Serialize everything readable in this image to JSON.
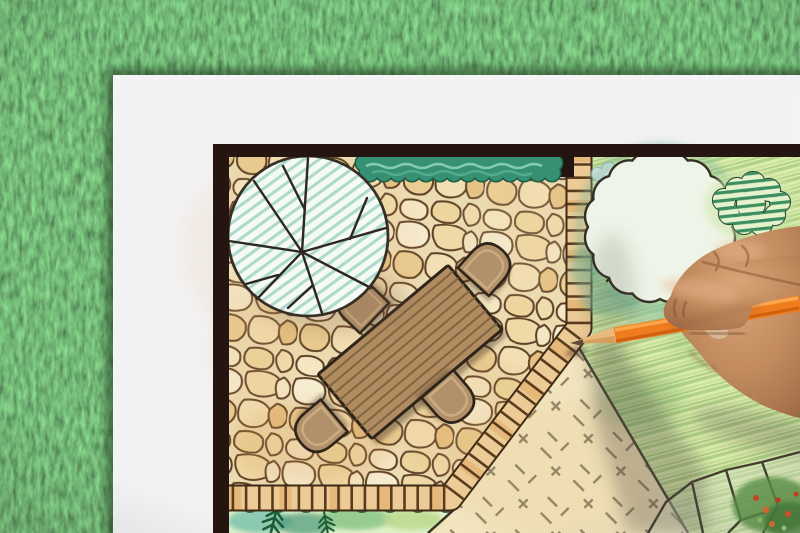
{
  "scene": {
    "type": "photograph",
    "subject": "Hand drawing a backyard garden landscape design plan with colored pencils",
    "setting": "White paper sheet with a framed plan drawing lying on green artificial grass",
    "plan_elements": [
      "flagstone patio",
      "round shade tree symbol with radiating branches",
      "clipped hedge strip",
      "brick paver border path",
      "rectangular wood-plank dining table",
      "four rounded patio chairs",
      "hatched lawn area",
      "scalloped round tree on lawn",
      "striped shrub",
      "gravel area with tick marks",
      "planting bed with ferns",
      "rock cluster outline",
      "flower bed in corner"
    ],
    "hand": "right hand gripping an orange colored pencil, tip resting at the patio corner"
  },
  "colors": {
    "grass": "#47763a",
    "paper": "#f5f5f7",
    "frame": "#241511",
    "stoneJoint": "#ecdcb2",
    "stoneLine": "#5d3f26",
    "paver": "#eccb96",
    "hedge": "#369074",
    "treeHatch": "#a6d6c6",
    "table": "#b08c60",
    "chair": "#b2906a",
    "outline": "#2e241a",
    "lawn": "#dcedb0",
    "lawnStripe": "#a8cc7e",
    "gravel": "#f2e5bf",
    "bedTeal": "#7fc4b0",
    "fern": "#1e5c36",
    "pencil": "#ef7d1e",
    "pencilWood": "#eab97e",
    "graphite": "#5a4b3e",
    "skinLight": "#d8a478",
    "skinMid": "#c08a5e",
    "skinDark": "#9a6644",
    "shadow": "rgba(70,64,52,0.30)"
  }
}
